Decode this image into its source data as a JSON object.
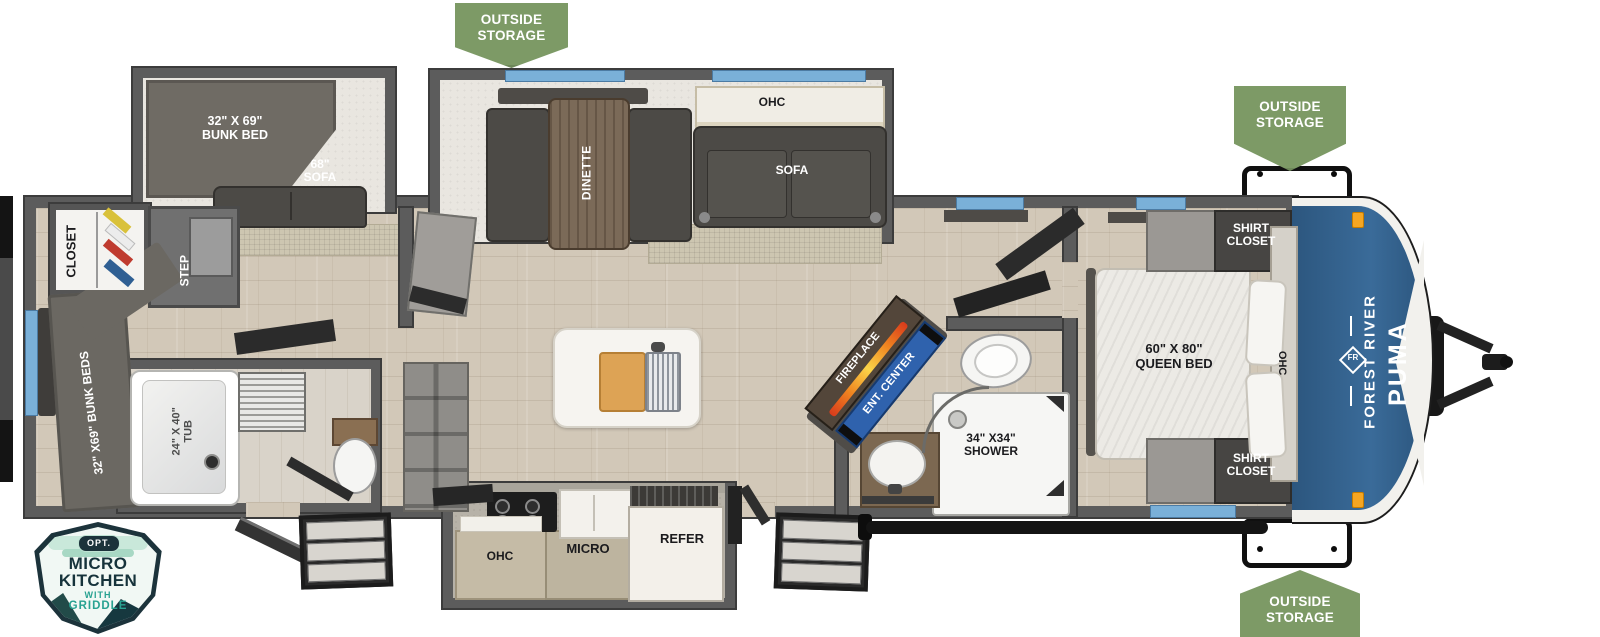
{
  "badges": {
    "outside_storage_top": {
      "line1": "OUTSIDE",
      "line2": "STORAGE"
    },
    "outside_storage_front_top": {
      "line1": "OUTSIDE",
      "line2": "STORAGE"
    },
    "outside_storage_front_bottom": {
      "line1": "OUTSIDE",
      "line2": "STORAGE"
    },
    "micro_kitchen": {
      "opt": "OPT.",
      "line1": "MICRO",
      "line2": "KITCHEN",
      "line3": "WITH",
      "line4": "GRIDDLE"
    }
  },
  "rear_bunk_room": {
    "closet": "CLOSET",
    "step": "STEP",
    "bunk_beds": "32\" X69\" BUNK BEDS"
  },
  "rear_bath": {
    "tub_line1": "24\" X 40\"",
    "tub_line2": "TUB"
  },
  "bunk_slide": {
    "bunk_line1": "32\" X 69\"",
    "bunk_line2": "BUNK BED",
    "sofa_line1": "68\"",
    "sofa_line2": "SOFA"
  },
  "dinette_slide": {
    "dinette": "DINETTE",
    "ohc": "OHC",
    "sofa": "SOFA"
  },
  "living": {
    "fireplace": "FIREPLACE",
    "ent_center": "ENT. CENTER"
  },
  "kitchen_slide": {
    "ohc": "OHC",
    "micro": "MICRO",
    "refer": "REFER"
  },
  "main_bath": {
    "shower_line1": "34\" X34\"",
    "shower_line2": "SHOWER"
  },
  "bedroom": {
    "bed_line1": "60\" X 80\"",
    "bed_line2": "QUEEN BED",
    "shirt_closet_top_line1": "SHIRT",
    "shirt_closet_top_line2": "CLOSET",
    "shirt_closet_bottom_line1": "SHIRT",
    "shirt_closet_bottom_line2": "CLOSET",
    "ohc": "OHC"
  },
  "brand": {
    "manufacturer": "FOREST RIVER",
    "model": "PUMA",
    "logo": "FR"
  },
  "colors": {
    "badge_green": "#7d9a66",
    "cap_blue": "#33608c",
    "ent_center_blue": "#2f62ad",
    "window_blue": "#7ab0d8",
    "badge_teal": "#28a291",
    "badge_navy": "#16333b",
    "wall_gray": "#5c5c5c"
  }
}
